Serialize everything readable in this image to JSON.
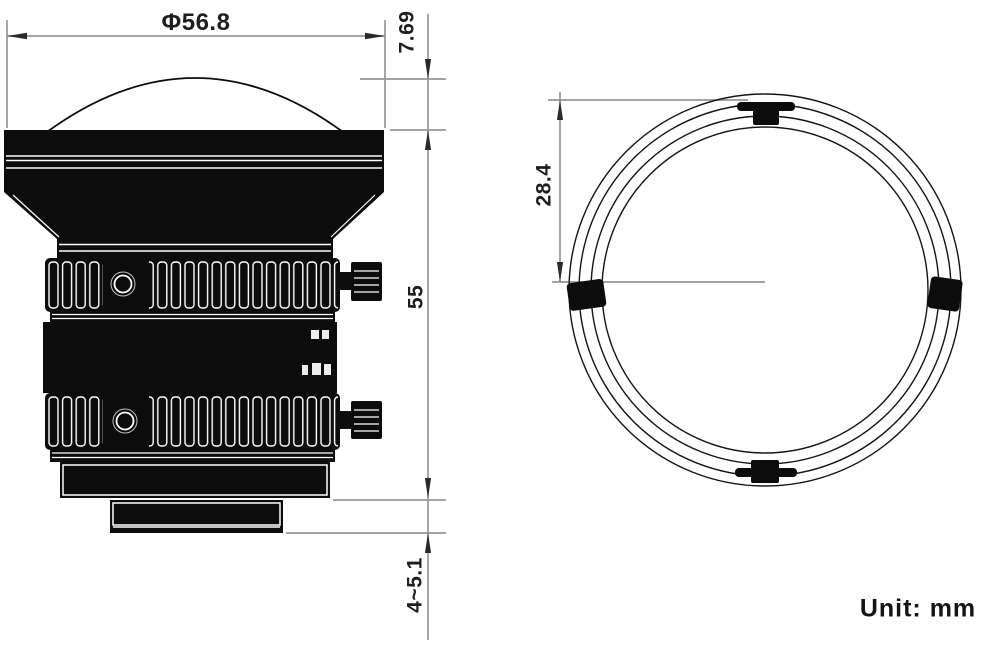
{
  "title": "Lens mechanical drawing",
  "unit_label": "Unit: mm",
  "colors": {
    "ink": "#0c0c0c",
    "dimension_line": "#969696",
    "arrow": "#2a2a2a",
    "detail_line": "#ffffff",
    "background": "#ffffff"
  },
  "side_view": {
    "name": "lens side view",
    "dimensions": {
      "diameter": "Φ56.8",
      "dome_height": "7.69",
      "body_length": "55",
      "mount_depth": "4~5.1"
    }
  },
  "front_view": {
    "name": "lens front view",
    "dimensions": {
      "radius": "28.4"
    }
  }
}
